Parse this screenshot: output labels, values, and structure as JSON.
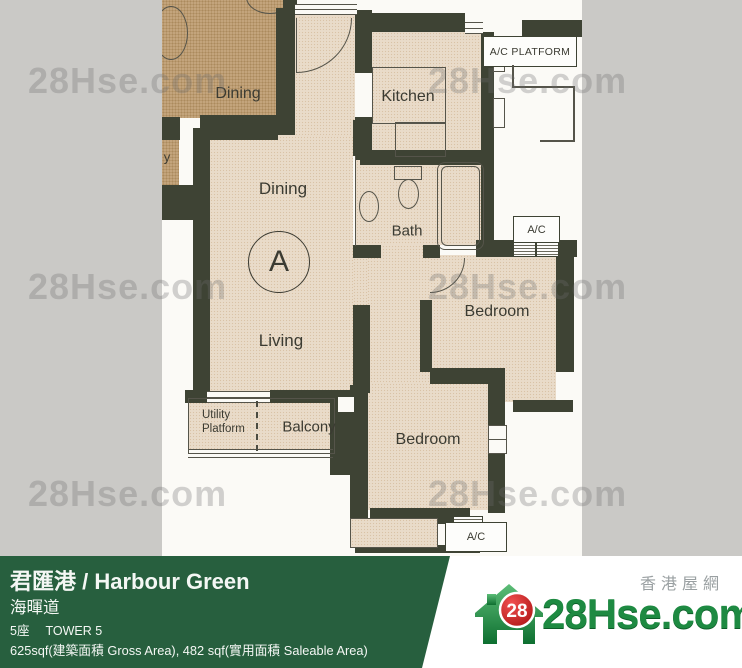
{
  "colors": {
    "background_gray": "#cac9c6",
    "scan_white": "#fbfaf6",
    "wall": "#3e4334",
    "room_fill": "#e9dbc9",
    "neighbor_fill": "#c3a47c",
    "footer_green": "#275f3e",
    "brand_green": "#1e8a42",
    "brand_red": "#cc1b1b",
    "watermark_color": "rgba(108,108,108,0.30)"
  },
  "watermark": {
    "text": "28Hse.com"
  },
  "plan": {
    "labels": {
      "neighbor_dining": "Dining",
      "neighbor_cutoff": "y",
      "dining": "Dining",
      "living": "Living",
      "kitchen": "Kitchen",
      "bath": "Bath",
      "bedroom_right": "Bedroom",
      "bedroom_bottom": "Bedroom",
      "balcony": "Balcony",
      "utility_line1": "Utility",
      "utility_line2": "Platform",
      "unit_marker": "A",
      "ac_platform": "A/C PLATFORM",
      "ac_upper": "A/C",
      "ac_lower": "A/C"
    }
  },
  "footer": {
    "title": "君匯港 / Harbour Green",
    "address": "海暉道",
    "tower_zh": "5座",
    "tower_en": "TOWER 5",
    "area": "625sqf(建築面積 Gross Area), 482 sqf(實用面積 Saleable Area)"
  },
  "brand": {
    "badge": "28",
    "name": "28Hse.com",
    "tagline": "香港屋網"
  }
}
